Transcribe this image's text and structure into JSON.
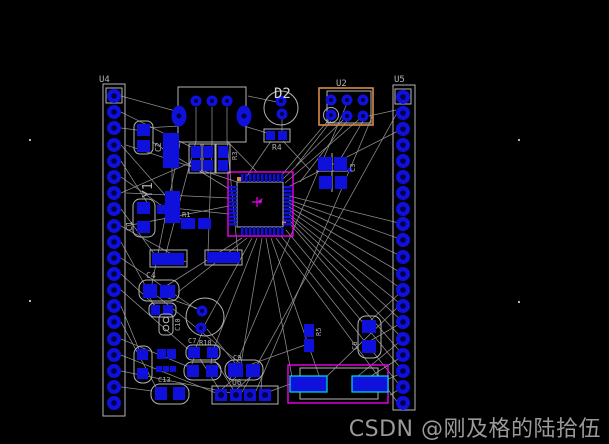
{
  "watermark": "CSDN @刚及格的陆拾伍",
  "colors": {
    "background": "#000000",
    "pad_blue": "#1010dc",
    "hole": "#000045",
    "silk": "#b4b4b4",
    "ratsnest": "#8f8f8f",
    "courtyard_magenta": "#ee00ee",
    "highlight_orange": "#d98b4a",
    "pad_cyan_edge": "#00e0e0",
    "label_gray": "#b0b0b0",
    "watermark_gray": "#9a9a9a"
  },
  "designators": {
    "u4": "U4",
    "u5": "U5",
    "u2": "U2",
    "u6": "U6",
    "d2": "D2",
    "r4": "R4",
    "y1": "Y1",
    "c1": "C1",
    "c2": "C2",
    "c3": "C3",
    "r1": "R1",
    "r3": "R3",
    "c4": "C4",
    "c7": "C7",
    "r10": "R10",
    "c9": "C9",
    "c10": "C10",
    "c13": "C13",
    "r5": "R5",
    "c6": "C6"
  }
}
